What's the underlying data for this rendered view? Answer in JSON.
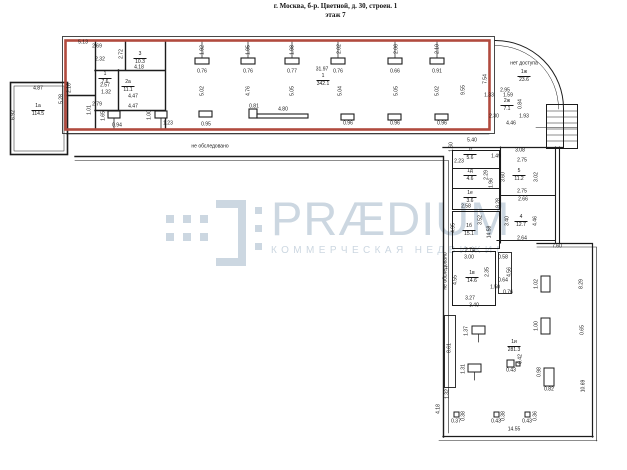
{
  "title": {
    "address": "г. Москва, б-р. Цветной, д. 30, строен. 1",
    "floor": "этаж 7"
  },
  "watermark": {
    "brand": "PRÆDIUM",
    "tagline": "КОММЕРЧЕСКАЯ НЕДВИЖИМ",
    "color": "#ccd7e1"
  },
  "colors": {
    "wall": "#1c1c1c",
    "highlighted_room_outline": "#b14a3e",
    "background": "#ffffff"
  },
  "rooms": [
    {
      "id": "1а",
      "area": "114.5",
      "x": 38,
      "y": 104
    },
    {
      "id": "3",
      "area": "10.3",
      "x": 140,
      "y": 52
    },
    {
      "id": "1",
      "area": "7.6",
      "x": 105,
      "y": 72
    },
    {
      "id": "2а",
      "area": "11.1",
      "x": 128,
      "y": 80
    },
    {
      "id": "1",
      "area": "342.1",
      "x": 323,
      "y": 74
    },
    {
      "id": "1ж",
      "area": "23.6",
      "x": 524,
      "y": 70
    },
    {
      "id": "2ж",
      "area": "7.1",
      "x": 507,
      "y": 99
    },
    {
      "id": "1г",
      "area": "5.6",
      "x": 470,
      "y": 148
    },
    {
      "id": "1д",
      "area": "4.6",
      "x": 470,
      "y": 169
    },
    {
      "id": "1е",
      "area": "3.6",
      "x": 470,
      "y": 191
    },
    {
      "id": "5",
      "area": "11.2",
      "x": 519,
      "y": 169
    },
    {
      "id": "4",
      "area": "12.7",
      "x": 521,
      "y": 215
    },
    {
      "id": "1б",
      "area": "15.1",
      "x": 469,
      "y": 224
    },
    {
      "id": "1в",
      "area": "14.6",
      "x": 472,
      "y": 271
    },
    {
      "id": "1и",
      "area": "281.3",
      "x": 514,
      "y": 340
    }
  ],
  "dims": [
    {
      "t": "4.87",
      "x": 38,
      "y": 89,
      "r": 0
    },
    {
      "t": "6.92",
      "x": 14,
      "y": 115,
      "r": 1
    },
    {
      "t": "5.28",
      "x": 62,
      "y": 99,
      "r": 1
    },
    {
      "t": "2.16",
      "x": 70,
      "y": 88,
      "r": 1
    },
    {
      "t": "5.13",
      "x": 83,
      "y": 43,
      "r": 0
    },
    {
      "t": "2.69",
      "x": 97,
      "y": 47,
      "r": 0
    },
    {
      "t": "2.32",
      "x": 100,
      "y": 60,
      "r": 0
    },
    {
      "t": "2.72",
      "x": 122,
      "y": 54,
      "r": 1
    },
    {
      "t": "4.18",
      "x": 139,
      "y": 68,
      "r": 0
    },
    {
      "t": "2.57",
      "x": 105,
      "y": 86,
      "r": 0
    },
    {
      "t": "1.32",
      "x": 106,
      "y": 93,
      "r": 0
    },
    {
      "t": "4.47",
      "x": 133,
      "y": 97,
      "r": 0
    },
    {
      "t": "4.47",
      "x": 133,
      "y": 107,
      "r": 0
    },
    {
      "t": "2.79",
      "x": 97,
      "y": 105,
      "r": 0
    },
    {
      "t": "1.01",
      "x": 90,
      "y": 110,
      "r": 1
    },
    {
      "t": "1.65",
      "x": 104,
      "y": 116,
      "r": 1
    },
    {
      "t": "0.94",
      "x": 117,
      "y": 126,
      "r": 0
    },
    {
      "t": "1.00",
      "x": 150,
      "y": 115,
      "r": 1
    },
    {
      "t": "1.23",
      "x": 168,
      "y": 124,
      "r": 0
    },
    {
      "t": "1.92",
      "x": 203,
      "y": 50,
      "r": 1
    },
    {
      "t": "1.95",
      "x": 249,
      "y": 50,
      "r": 1
    },
    {
      "t": "1.98",
      "x": 293,
      "y": 50,
      "r": 1
    },
    {
      "t": "2.02",
      "x": 340,
      "y": 49,
      "r": 1
    },
    {
      "t": "2.06",
      "x": 397,
      "y": 49,
      "r": 1
    },
    {
      "t": "2.10",
      "x": 438,
      "y": 49,
      "r": 1
    },
    {
      "t": "0.76",
      "x": 202,
      "y": 72,
      "r": 0
    },
    {
      "t": "0.76",
      "x": 248,
      "y": 72,
      "r": 0
    },
    {
      "t": "0.77",
      "x": 292,
      "y": 72,
      "r": 0
    },
    {
      "t": "0.76",
      "x": 338,
      "y": 72,
      "r": 0
    },
    {
      "t": "0.66",
      "x": 395,
      "y": 72,
      "r": 0
    },
    {
      "t": "0.91",
      "x": 437,
      "y": 72,
      "r": 0
    },
    {
      "t": "31.97",
      "x": 322,
      "y": 70,
      "r": 0
    },
    {
      "t": "5.02",
      "x": 203,
      "y": 91,
      "r": 1
    },
    {
      "t": "4.76",
      "x": 249,
      "y": 91,
      "r": 1
    },
    {
      "t": "5.05",
      "x": 293,
      "y": 91,
      "r": 1
    },
    {
      "t": "5.04",
      "x": 341,
      "y": 91,
      "r": 1
    },
    {
      "t": "5.05",
      "x": 397,
      "y": 91,
      "r": 1
    },
    {
      "t": "5.02",
      "x": 438,
      "y": 91,
      "r": 1
    },
    {
      "t": "9.55",
      "x": 464,
      "y": 90,
      "r": 1
    },
    {
      "t": "7.54",
      "x": 486,
      "y": 79,
      "r": 1
    },
    {
      "t": "0.95",
      "x": 206,
      "y": 125,
      "r": 0
    },
    {
      "t": "0.81",
      "x": 254,
      "y": 107,
      "r": 0
    },
    {
      "t": "4.80",
      "x": 283,
      "y": 110,
      "r": 0
    },
    {
      "t": "0.96",
      "x": 348,
      "y": 124,
      "r": 0
    },
    {
      "t": "0.96",
      "x": 395,
      "y": 124,
      "r": 0
    },
    {
      "t": "0.96",
      "x": 442,
      "y": 124,
      "r": 0
    },
    {
      "t": "не обследовано",
      "x": 210,
      "y": 147,
      "r": 0
    },
    {
      "t": "не обследовано",
      "x": 446,
      "y": 271,
      "r": 1
    },
    {
      "t": "нет доступа",
      "x": 524,
      "y": 64,
      "r": 0
    },
    {
      "t": "2.95",
      "x": 505,
      "y": 91,
      "r": 0
    },
    {
      "t": "1.33",
      "x": 489,
      "y": 96,
      "r": 0
    },
    {
      "t": "1.59",
      "x": 508,
      "y": 96,
      "r": 0
    },
    {
      "t": "0.84",
      "x": 521,
      "y": 104,
      "r": 1
    },
    {
      "t": "2.30",
      "x": 494,
      "y": 117,
      "r": 0
    },
    {
      "t": "1.93",
      "x": 524,
      "y": 117,
      "r": 0
    },
    {
      "t": "4.46",
      "x": 511,
      "y": 124,
      "r": 0
    },
    {
      "t": "1.60",
      "x": 452,
      "y": 147,
      "r": 1
    },
    {
      "t": "5.40",
      "x": 472,
      "y": 141,
      "r": 0
    },
    {
      "t": "1.49",
      "x": 496,
      "y": 157,
      "r": 0
    },
    {
      "t": "3.08",
      "x": 520,
      "y": 151,
      "r": 0
    },
    {
      "t": "2.75",
      "x": 522,
      "y": 161,
      "r": 0
    },
    {
      "t": "3.60",
      "x": 504,
      "y": 177,
      "r": 1
    },
    {
      "t": "3.02",
      "x": 537,
      "y": 177,
      "r": 1
    },
    {
      "t": "2.75",
      "x": 522,
      "y": 192,
      "r": 0
    },
    {
      "t": "2.66",
      "x": 523,
      "y": 200,
      "r": 0
    },
    {
      "t": "3.40",
      "x": 508,
      "y": 221,
      "r": 1
    },
    {
      "t": "4.46",
      "x": 536,
      "y": 221,
      "r": 1
    },
    {
      "t": "2.64",
      "x": 522,
      "y": 239,
      "r": 0
    },
    {
      "t": "9.28",
      "x": 499,
      "y": 203,
      "r": 1
    },
    {
      "t": "14.58",
      "x": 490,
      "y": 232,
      "r": 1
    },
    {
      "t": "2.23",
      "x": 459,
      "y": 162,
      "r": 0
    },
    {
      "t": "2.29",
      "x": 487,
      "y": 175,
      "r": 1
    },
    {
      "t": "1.96",
      "x": 492,
      "y": 183,
      "r": 1
    },
    {
      "t": "2.58",
      "x": 466,
      "y": 207,
      "r": 0
    },
    {
      "t": "3.52",
      "x": 481,
      "y": 220,
      "r": 1
    },
    {
      "t": "4.95",
      "x": 454,
      "y": 228,
      "r": 1
    },
    {
      "t": "2.74",
      "x": 470,
      "y": 251,
      "r": 0
    },
    {
      "t": "3.00",
      "x": 469,
      "y": 258,
      "r": 0
    },
    {
      "t": "4.55",
      "x": 456,
      "y": 280,
      "r": 1
    },
    {
      "t": "2.35",
      "x": 488,
      "y": 272,
      "r": 1
    },
    {
      "t": "3.27",
      "x": 470,
      "y": 299,
      "r": 0
    },
    {
      "t": "3.40",
      "x": 474,
      "y": 306,
      "r": 0
    },
    {
      "t": "0.58",
      "x": 503,
      "y": 258,
      "r": 0
    },
    {
      "t": "4.56",
      "x": 510,
      "y": 272,
      "r": 1
    },
    {
      "t": "0.64",
      "x": 503,
      "y": 281,
      "r": 0
    },
    {
      "t": "1.50",
      "x": 495,
      "y": 288,
      "r": 0
    },
    {
      "t": "0.76",
      "x": 508,
      "y": 293,
      "r": 0
    },
    {
      "t": "7.60",
      "x": 557,
      "y": 247,
      "r": 0
    },
    {
      "t": "1.02",
      "x": 537,
      "y": 284,
      "r": 1
    },
    {
      "t": "1.00",
      "x": 537,
      "y": 326,
      "r": 1
    },
    {
      "t": "8.29",
      "x": 582,
      "y": 284,
      "r": 1
    },
    {
      "t": "0.65",
      "x": 583,
      "y": 330,
      "r": 1
    },
    {
      "t": "10.69",
      "x": 584,
      "y": 386,
      "r": 1
    },
    {
      "t": "1.37",
      "x": 467,
      "y": 331,
      "r": 1
    },
    {
      "t": "1.31",
      "x": 464,
      "y": 369,
      "r": 1
    },
    {
      "t": "0.42",
      "x": 521,
      "y": 359,
      "r": 1
    },
    {
      "t": "0.43",
      "x": 511,
      "y": 371,
      "r": 0
    },
    {
      "t": "0.98",
      "x": 540,
      "y": 372,
      "r": 1
    },
    {
      "t": "0.82",
      "x": 549,
      "y": 390,
      "r": 0
    },
    {
      "t": "0.37",
      "x": 456,
      "y": 422,
      "r": 0
    },
    {
      "t": "0.38",
      "x": 464,
      "y": 416,
      "r": 1
    },
    {
      "t": "0.43",
      "x": 496,
      "y": 422,
      "r": 0
    },
    {
      "t": "0.38",
      "x": 504,
      "y": 416,
      "r": 1
    },
    {
      "t": "0.43",
      "x": 527,
      "y": 422,
      "r": 0
    },
    {
      "t": "0.36",
      "x": 536,
      "y": 416,
      "r": 1
    },
    {
      "t": "14.55",
      "x": 514,
      "y": 430,
      "r": 0
    },
    {
      "t": "8.61",
      "x": 450,
      "y": 348,
      "r": 1
    },
    {
      "t": "1.32",
      "x": 448,
      "y": 394,
      "r": 1
    },
    {
      "t": "4.18",
      "x": 439,
      "y": 409,
      "r": 1
    }
  ]
}
